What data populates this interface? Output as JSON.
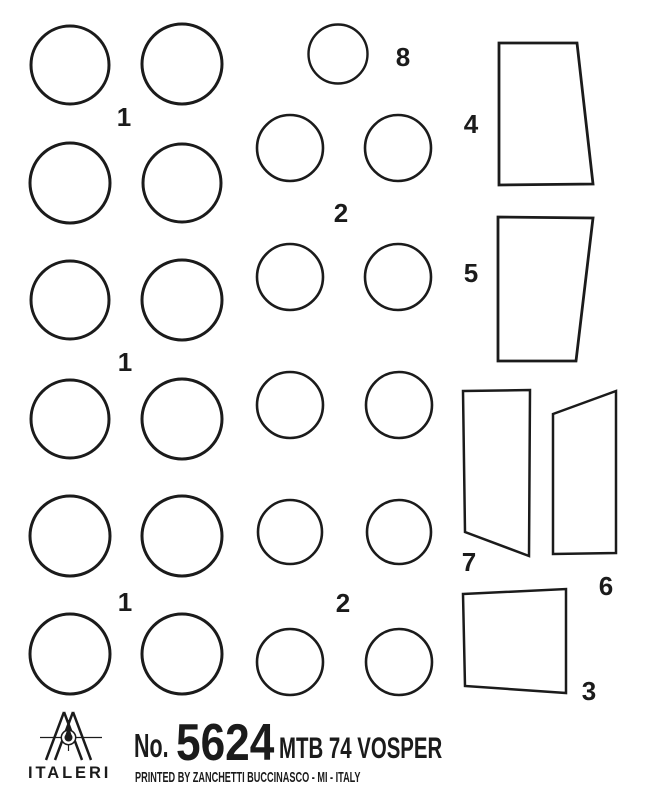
{
  "ink_color": "#1b1b1b",
  "background_color": "#ffffff",
  "part_numbers": {
    "n1": "1",
    "n2": "2",
    "n3": "3",
    "n4": "4",
    "n5": "5",
    "n6": "6",
    "n7": "7",
    "n8": "8"
  },
  "footer": {
    "brand": "ITALERI",
    "no_prefix": "No.",
    "kit_number": "5624",
    "kit_title": "MTB 74 VOSPER",
    "printed_by": "PRINTED BY ZANCHETTI BUCCINASCO - MI - ITALY"
  }
}
